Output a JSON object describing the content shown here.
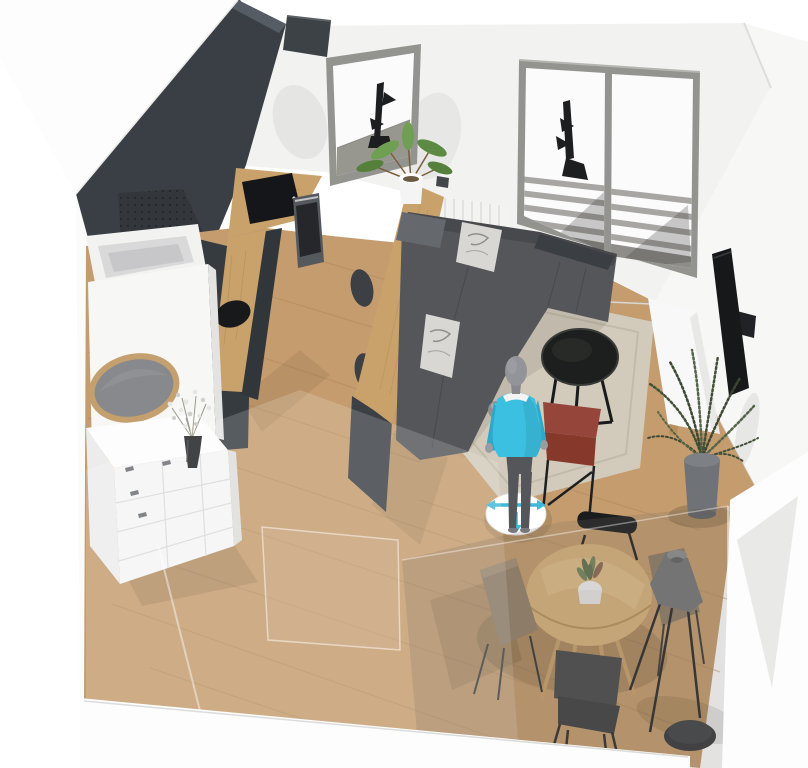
{
  "view": {
    "label": "3D furnished room perspective view",
    "tool": "room-planner-viewport"
  },
  "colors": {
    "background": "#ffffff",
    "wall_back": "#f2f2f1",
    "wall_right": "#f7f7f6",
    "wall_outside": "#fdfdfd",
    "wall_dark": "#3a3f45",
    "wall_dark_lit": "#565c63",
    "floor_wood": "#c49c6d",
    "floor_seam": "#a8845c",
    "counter_wood": "#c9a26b",
    "table_wood": "#d7b37c",
    "cabinet_dark": "#363b40",
    "cooktop_black": "#141619",
    "oven_steel": "#55595e",
    "sofa": "#54565a",
    "sofa_headrest": "#3b3e42",
    "pillow": "#d8d7d4",
    "rug": "#d2cabb",
    "coffee_table": "#1c1f1d",
    "bench_red": "#86382a",
    "tv_black": "#17181a",
    "stand_white": "#f8f8f8",
    "plant_green": "#43513a",
    "leaf_green": "#6f9f52",
    "pot_gray": "#6f7276",
    "chair_black": "#1b1c1e",
    "chair_gray": "#47494d",
    "chair_tan": "#92806a",
    "lamp_gray": "#73767a",
    "lamp_base": "#35383c",
    "mirror_rim": "#c5a06f",
    "mirror_glass": "#87898d",
    "unit_white": "#f5f5f6",
    "window_frame": "#93938f",
    "glass_white": "#fbfbfc",
    "railing_gray": "#a7a6a2",
    "radiator_white": "#f3f3f2",
    "vase_black": "#1c1d1f",
    "avatar_shirt": "#3cc0e2",
    "avatar_pants": "#55565a",
    "avatar_skin": "#93949a",
    "disc_white": "#ffffff",
    "move_arrow": "#3fb9da"
  },
  "scene": {
    "walls": [
      "white-exterior-wall",
      "dark-feature-wall",
      "back-wall",
      "right-wall",
      "glass-front-walls"
    ],
    "objects": [
      "kitchen-hood",
      "perforated-vent-panel",
      "kitchen-counter",
      "induction-cooktop",
      "built-in-oven",
      "round-sink",
      "window",
      "french-doors",
      "balcony-railing",
      "outdoor-wall-lamp",
      "radiator",
      "bar-counter",
      "bar-stools",
      "potted-plant-on-bar",
      "corner-sofa",
      "cushions",
      "round-coffee-table",
      "area-rug",
      "decor-sphere",
      "red-side-bench",
      "wall-mounted-tv",
      "white-tv-stand",
      "fern-floor-plant",
      "oval-mirror",
      "white-drawer-unit",
      "vase-with-flowers",
      "round-dining-table",
      "succulent-centerpiece",
      "dining-chairs",
      "tripod-floor-lamp"
    ],
    "avatar": {
      "type": "person-figure",
      "shirt": "cyan",
      "widget": "move-control",
      "arrows": [
        "left",
        "right",
        "down"
      ]
    }
  }
}
